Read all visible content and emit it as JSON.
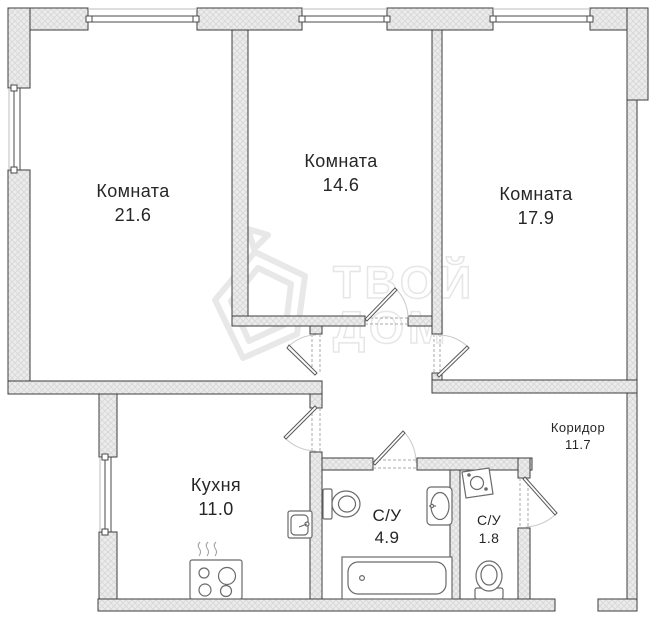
{
  "plan": {
    "rooms": [
      {
        "id": "room-21-6",
        "name": "Комната",
        "area": "21.6"
      },
      {
        "id": "room-14-6",
        "name": "Комната",
        "area": "14.6"
      },
      {
        "id": "room-17-9",
        "name": "Комната",
        "area": "17.9"
      },
      {
        "id": "kitchen",
        "name": "Кухня",
        "area": "11.0"
      },
      {
        "id": "bathroom",
        "name": "С/У",
        "area": "4.9"
      },
      {
        "id": "wc",
        "name": "С/У",
        "area": "1.8"
      },
      {
        "id": "corridor",
        "name": "Коридор",
        "area": "11.7"
      }
    ],
    "watermark": {
      "line1": "ТВОЙ",
      "line2": "ДОМ"
    },
    "colors": {
      "wall_fill": "#ececec",
      "wall_hatch": "#d9d9d9",
      "outline": "#3d3d3d",
      "door_arc": "#c9c9c9",
      "watermark": "#e4e4e4",
      "text": "#262626"
    }
  }
}
